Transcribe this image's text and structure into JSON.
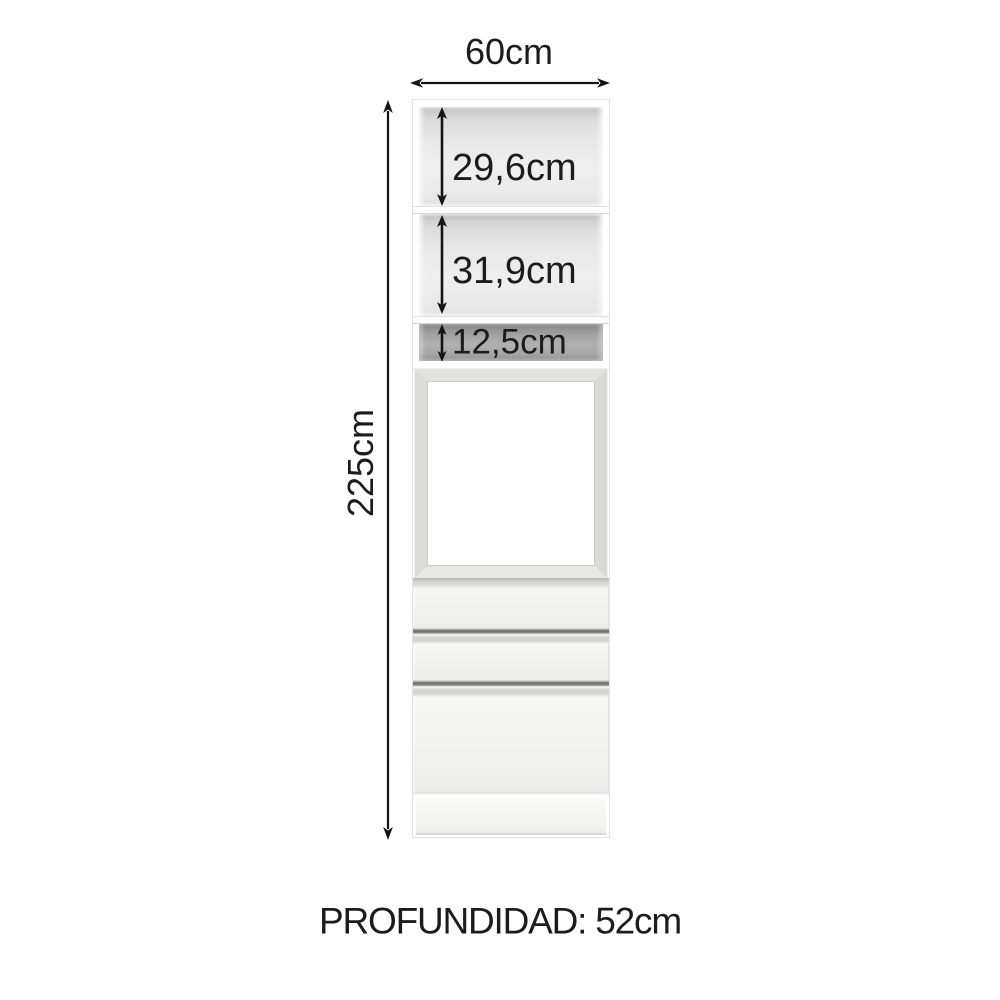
{
  "dimensions": {
    "width_label": "60cm",
    "height_label": "225cm",
    "depth_label": "PROFUNDIDAD: 52cm"
  },
  "compartments": [
    {
      "label": "29,6cm"
    },
    {
      "label": "31,9cm"
    },
    {
      "label": "12,5cm"
    }
  ],
  "colors": {
    "text": "#1c1c1c",
    "arrow": "#141414",
    "cabinet_face": "#f4f4f2",
    "interior_gray": "#e7e7e7",
    "niche_gray": "#a3a3a3",
    "handle_gray": "#d6d6d1"
  }
}
